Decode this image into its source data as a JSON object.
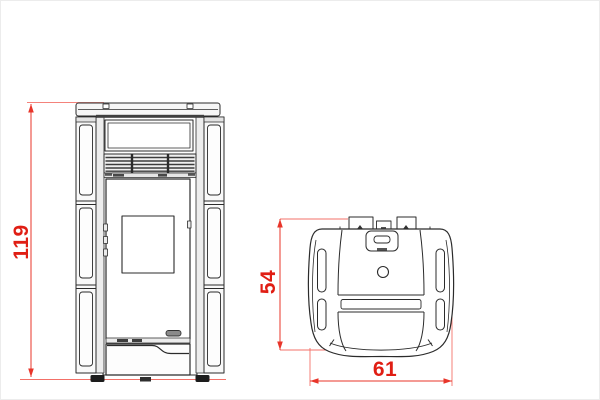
{
  "page": {
    "background_color": "#ffffff"
  },
  "drawing": {
    "stroke_color": "#2b2b2b",
    "dimension_line_color": "#e8352a",
    "dimension_text_color": "#e01e14",
    "dimensions": {
      "height": {
        "value": "119",
        "orientation": "vertical",
        "applies_to": "front-view"
      },
      "depth": {
        "value": "54",
        "orientation": "vertical",
        "applies_to": "top-view"
      },
      "width": {
        "value": "61",
        "orientation": "horizontal",
        "applies_to": "top-view"
      }
    }
  }
}
